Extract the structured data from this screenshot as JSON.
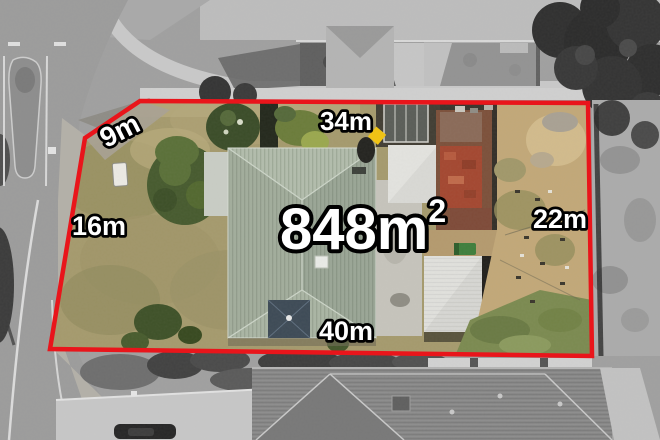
{
  "aerial_annotation": {
    "area": {
      "value": "848m",
      "superscript": "2"
    },
    "side_lengths": {
      "corner_northwest": "9m",
      "north": "34m",
      "west": "16m",
      "east": "22m",
      "south": "40m"
    },
    "style": {
      "boundary_color": "#e9151b",
      "label_fill": "#ffffff",
      "label_outline": "#000000",
      "marker_color": "#f2c410"
    }
  }
}
